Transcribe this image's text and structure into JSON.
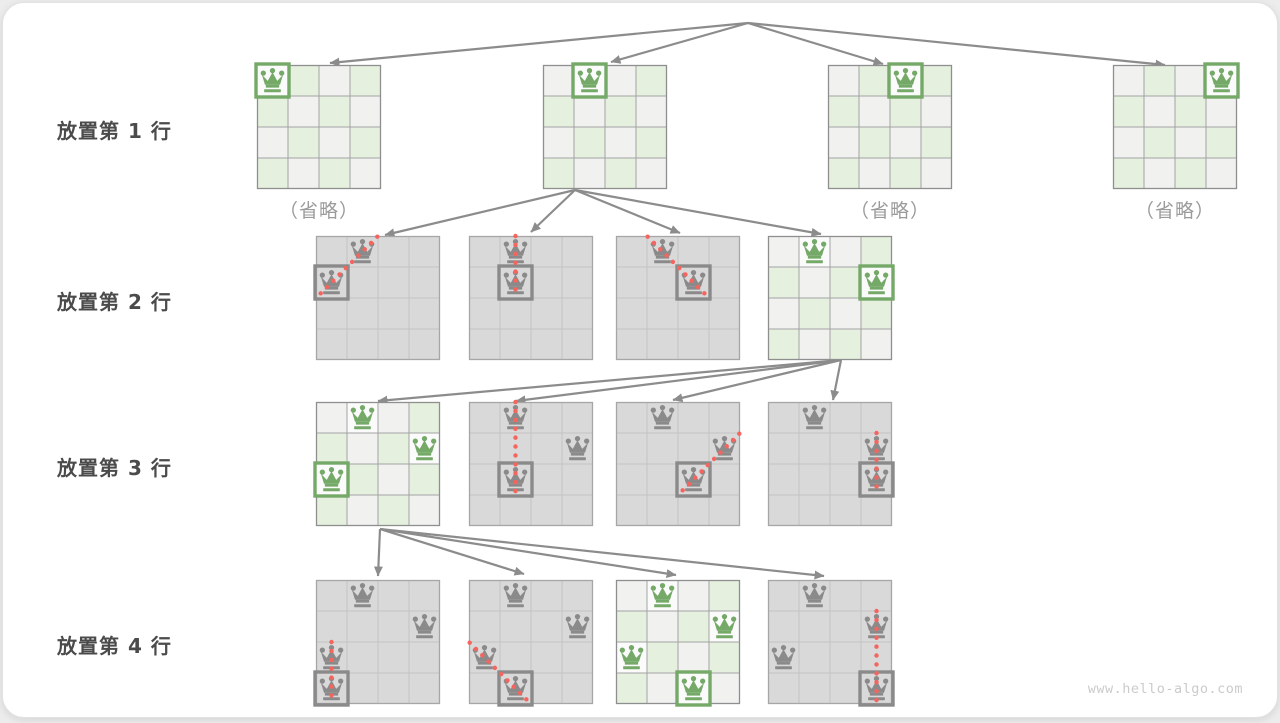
{
  "labels": {
    "rows": [
      "放置第 1 行",
      "放置第 2 行",
      "放置第 3 行",
      "放置第 4 行"
    ],
    "omitted": "（省略）",
    "watermark": "www.hello-algo.com"
  },
  "colors": {
    "queen_green": "#74a968",
    "queen_gray": "#8a8a8a",
    "cell_green": "#e5f0df",
    "cell_light": "#f1f1f0",
    "cell_queen_bg": "#fbfbfb",
    "cell_gray": "#d9d9d9",
    "grid_green": "#a3a3a3",
    "border_green": "#8f8f8f",
    "grid_gray": "#c2c2c2",
    "border_gray": "#a6a6a6",
    "arrow": "#8c8c8c",
    "conflict_dot": "#f4655f"
  },
  "boards": [
    {
      "id": "r1-1",
      "group": 0,
      "index": 0,
      "theme": "green",
      "omitted": true,
      "queens": [
        {
          "r": 0,
          "c": 0,
          "is_new": true
        }
      ],
      "conflict": null
    },
    {
      "id": "r1-2",
      "group": 0,
      "index": 1,
      "theme": "green",
      "omitted": false,
      "queens": [
        {
          "r": 0,
          "c": 1,
          "is_new": true
        }
      ],
      "conflict": null
    },
    {
      "id": "r1-3",
      "group": 0,
      "index": 2,
      "theme": "green",
      "omitted": true,
      "queens": [
        {
          "r": 0,
          "c": 2,
          "is_new": true
        }
      ],
      "conflict": null
    },
    {
      "id": "r1-4",
      "group": 0,
      "index": 3,
      "theme": "green",
      "omitted": true,
      "queens": [
        {
          "r": 0,
          "c": 3,
          "is_new": true
        }
      ],
      "conflict": null
    },
    {
      "id": "r2-1",
      "group": 1,
      "index": 0,
      "theme": "gray",
      "omitted": false,
      "queens": [
        {
          "r": 0,
          "c": 1,
          "is_new": false
        },
        {
          "r": 1,
          "c": 0,
          "is_new": true
        }
      ],
      "conflict": {
        "from": [
          0,
          1
        ],
        "to": [
          1,
          0
        ]
      }
    },
    {
      "id": "r2-2",
      "group": 1,
      "index": 1,
      "theme": "gray",
      "omitted": false,
      "queens": [
        {
          "r": 0,
          "c": 1,
          "is_new": false
        },
        {
          "r": 1,
          "c": 1,
          "is_new": true
        }
      ],
      "conflict": {
        "from": [
          0,
          1
        ],
        "to": [
          1,
          1
        ]
      }
    },
    {
      "id": "r2-3",
      "group": 1,
      "index": 2,
      "theme": "gray",
      "omitted": false,
      "queens": [
        {
          "r": 0,
          "c": 1,
          "is_new": false
        },
        {
          "r": 1,
          "c": 2,
          "is_new": true
        }
      ],
      "conflict": {
        "from": [
          0,
          1
        ],
        "to": [
          1,
          2
        ]
      }
    },
    {
      "id": "r2-4",
      "group": 1,
      "index": 3,
      "theme": "green",
      "omitted": false,
      "queens": [
        {
          "r": 0,
          "c": 1,
          "is_new": false
        },
        {
          "r": 1,
          "c": 3,
          "is_new": true
        }
      ],
      "conflict": null
    },
    {
      "id": "r3-1",
      "group": 2,
      "index": 0,
      "theme": "green",
      "omitted": false,
      "queens": [
        {
          "r": 0,
          "c": 1,
          "is_new": false
        },
        {
          "r": 1,
          "c": 3,
          "is_new": false
        },
        {
          "r": 2,
          "c": 0,
          "is_new": true
        }
      ],
      "conflict": null
    },
    {
      "id": "r3-2",
      "group": 2,
      "index": 1,
      "theme": "gray",
      "omitted": false,
      "queens": [
        {
          "r": 0,
          "c": 1,
          "is_new": false
        },
        {
          "r": 1,
          "c": 3,
          "is_new": false
        },
        {
          "r": 2,
          "c": 1,
          "is_new": true
        }
      ],
      "conflict": {
        "from": [
          0,
          1
        ],
        "to": [
          2,
          1
        ]
      }
    },
    {
      "id": "r3-3",
      "group": 2,
      "index": 2,
      "theme": "gray",
      "omitted": false,
      "queens": [
        {
          "r": 0,
          "c": 1,
          "is_new": false
        },
        {
          "r": 1,
          "c": 3,
          "is_new": false
        },
        {
          "r": 2,
          "c": 2,
          "is_new": true
        }
      ],
      "conflict": {
        "from": [
          1,
          3
        ],
        "to": [
          2,
          2
        ]
      }
    },
    {
      "id": "r3-4",
      "group": 2,
      "index": 3,
      "theme": "gray",
      "omitted": false,
      "queens": [
        {
          "r": 0,
          "c": 1,
          "is_new": false
        },
        {
          "r": 1,
          "c": 3,
          "is_new": false
        },
        {
          "r": 2,
          "c": 3,
          "is_new": true
        }
      ],
      "conflict": {
        "from": [
          1,
          3
        ],
        "to": [
          2,
          3
        ]
      }
    },
    {
      "id": "r4-1",
      "group": 3,
      "index": 0,
      "theme": "gray",
      "omitted": false,
      "queens": [
        {
          "r": 0,
          "c": 1,
          "is_new": false
        },
        {
          "r": 1,
          "c": 3,
          "is_new": false
        },
        {
          "r": 2,
          "c": 0,
          "is_new": false
        },
        {
          "r": 3,
          "c": 0,
          "is_new": true
        }
      ],
      "conflict": {
        "from": [
          2,
          0
        ],
        "to": [
          3,
          0
        ]
      }
    },
    {
      "id": "r4-2",
      "group": 3,
      "index": 1,
      "theme": "gray",
      "omitted": false,
      "queens": [
        {
          "r": 0,
          "c": 1,
          "is_new": false
        },
        {
          "r": 1,
          "c": 3,
          "is_new": false
        },
        {
          "r": 2,
          "c": 0,
          "is_new": false
        },
        {
          "r": 3,
          "c": 1,
          "is_new": true
        }
      ],
      "conflict": {
        "from": [
          2,
          0
        ],
        "to": [
          3,
          1
        ]
      }
    },
    {
      "id": "r4-3",
      "group": 3,
      "index": 2,
      "theme": "green",
      "omitted": false,
      "queens": [
        {
          "r": 0,
          "c": 1,
          "is_new": false
        },
        {
          "r": 1,
          "c": 3,
          "is_new": false
        },
        {
          "r": 2,
          "c": 0,
          "is_new": false
        },
        {
          "r": 3,
          "c": 2,
          "is_new": true
        }
      ],
      "conflict": null
    },
    {
      "id": "r4-4",
      "group": 3,
      "index": 3,
      "theme": "gray",
      "omitted": false,
      "queens": [
        {
          "r": 0,
          "c": 1,
          "is_new": false
        },
        {
          "r": 1,
          "c": 3,
          "is_new": false
        },
        {
          "r": 2,
          "c": 0,
          "is_new": false
        },
        {
          "r": 3,
          "c": 3,
          "is_new": true
        }
      ],
      "conflict": {
        "from": [
          1,
          3
        ],
        "to": [
          3,
          3
        ]
      }
    }
  ],
  "arrow_fans": [
    {
      "from": [
        745,
        20
      ],
      "to": [
        [
          327,
          60
        ],
        [
          608,
          59
        ],
        [
          880,
          61
        ],
        [
          1162,
          62
        ]
      ]
    },
    {
      "from": [
        572,
        187
      ],
      "to": [
        [
          382,
          232
        ],
        [
          528,
          229
        ],
        [
          677,
          230
        ],
        [
          818,
          231
        ]
      ]
    },
    {
      "from": [
        838,
        357
      ],
      "to": [
        [
          375,
          398
        ],
        [
          513,
          398
        ],
        [
          670,
          397
        ],
        [
          830,
          397
        ]
      ]
    },
    {
      "from": [
        377,
        526
      ],
      "to": [
        [
          375,
          573
        ],
        [
          521,
          571
        ],
        [
          673,
          572
        ],
        [
          821,
          573
        ]
      ]
    }
  ]
}
